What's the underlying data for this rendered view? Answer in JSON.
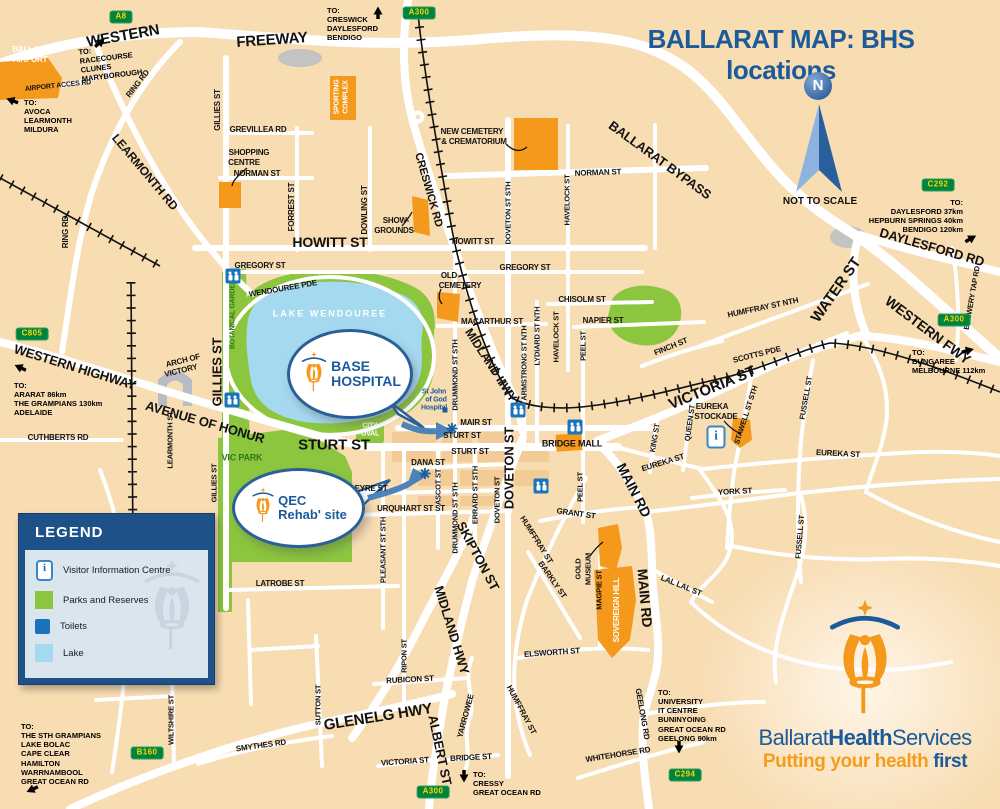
{
  "title": "BALLARAT MAP: BHS locations",
  "compass": {
    "letter": "N",
    "note": "NOT TO SCALE"
  },
  "legend": {
    "header": "LEGEND",
    "info_glyph": "i",
    "items": [
      {
        "icon": "visitor-info-icon",
        "label": "Visitor Information Centre"
      },
      {
        "icon": "parks-swatch",
        "label": "Parks and Reserves"
      },
      {
        "icon": "toilets-icon",
        "label": "Toilets"
      },
      {
        "icon": "lake-swatch",
        "label": "Lake"
      }
    ]
  },
  "callouts": {
    "base": {
      "line1": "BASE",
      "line2": "HOSPITAL"
    },
    "qec": {
      "line1": "QEC",
      "line2": "Rehab' site"
    }
  },
  "logo": {
    "word1": "Ballarat",
    "word2": "Health",
    "word3": "Services",
    "tag1": "Putting your health ",
    "tag2": "first"
  },
  "colors": {
    "accent_blue": "#1b5a9b",
    "orange": "#f5991c",
    "park_green": "#8cc63f",
    "lake_blue": "#a5d9ef",
    "sign_green": "#00833e",
    "sign_text": "#ffd400",
    "bg_tan": "#f8dcb2"
  },
  "signs": [
    {
      "label": "A8",
      "x": 121,
      "y": 17
    },
    {
      "label": "A300",
      "x": 419,
      "y": 13
    },
    {
      "label": "C292",
      "x": 938,
      "y": 185
    },
    {
      "label": "A300",
      "x": 954,
      "y": 320
    },
    {
      "label": "C805",
      "x": 32,
      "y": 334
    },
    {
      "label": "B160",
      "x": 147,
      "y": 753
    },
    {
      "label": "A300",
      "x": 433,
      "y": 792
    },
    {
      "label": "C294",
      "x": 685,
      "y": 775
    }
  ],
  "street_labels": [
    {
      "t": "WESTERN",
      "x": 123,
      "y": 36,
      "r": -10,
      "s": 15
    },
    {
      "t": "FREEWAY",
      "x": 272,
      "y": 40,
      "r": -4,
      "s": 15
    },
    {
      "t": "BALLARAT",
      "x": 33,
      "y": 50,
      "s": 8,
      "c": "#ffffff"
    },
    {
      "t": "AIRPORT",
      "x": 30,
      "y": 60,
      "s": 8,
      "c": "#ffffff"
    },
    {
      "t": "AIRPORT ACCES RD",
      "x": 58,
      "y": 86,
      "r": -6,
      "s": 7
    },
    {
      "t": "RING RD",
      "x": 138,
      "y": 84,
      "r": -52,
      "s": 8
    },
    {
      "t": "RING RD",
      "x": 66,
      "y": 232,
      "r": -90,
      "s": 8
    },
    {
      "t": "LEARMONTH RD",
      "x": 145,
      "y": 172,
      "r": 50,
      "s": 12
    },
    {
      "t": "GILLIES ST",
      "x": 218,
      "y": 110,
      "r": -90,
      "s": 8
    },
    {
      "t": "GREVILLEA RD",
      "x": 258,
      "y": 130,
      "s": 8
    },
    {
      "t": "SHOPPING",
      "x": 249,
      "y": 153,
      "s": 8
    },
    {
      "t": "CENTRE",
      "x": 244,
      "y": 163,
      "s": 8
    },
    {
      "t": "NORMAN ST",
      "x": 257,
      "y": 174,
      "s": 8
    },
    {
      "t": "FORREST ST",
      "x": 292,
      "y": 207,
      "r": -90,
      "s": 8
    },
    {
      "t": "DOWLING ST",
      "x": 365,
      "y": 210,
      "r": -90,
      "s": 8
    },
    {
      "t": "SPORTING",
      "x": 337,
      "y": 97,
      "r": -90,
      "s": 7,
      "c": "#ffffff"
    },
    {
      "t": "COMPLEX",
      "x": 346,
      "y": 97,
      "r": -90,
      "s": 7,
      "c": "#ffffff"
    },
    {
      "t": "CRESWICK RD",
      "x": 428,
      "y": 190,
      "r": 74,
      "s": 11
    },
    {
      "t": "NEW CEMETERY",
      "x": 472,
      "y": 132,
      "s": 8
    },
    {
      "t": "& CREMATORIUM",
      "x": 474,
      "y": 142,
      "s": 8
    },
    {
      "t": "NORMAN ST",
      "x": 598,
      "y": 173,
      "r": -2,
      "s": 8
    },
    {
      "t": "BALLARAT BYPASS",
      "x": 660,
      "y": 160,
      "r": 36,
      "s": 13
    },
    {
      "t": "DOVETON ST STH",
      "x": 508,
      "y": 213,
      "r": -90,
      "s": 7.5
    },
    {
      "t": "HAVELOCK ST",
      "x": 567,
      "y": 200,
      "r": -90,
      "s": 7.5
    },
    {
      "t": "SHOW-",
      "x": 396,
      "y": 221,
      "s": 8
    },
    {
      "t": "GROUNDS",
      "x": 394,
      "y": 231,
      "s": 8
    },
    {
      "t": "HOWITT ST",
      "x": 330,
      "y": 242,
      "s": 14
    },
    {
      "t": "HOWITT ST",
      "x": 473,
      "y": 242,
      "s": 8
    },
    {
      "t": "GREGORY ST",
      "x": 260,
      "y": 266,
      "s": 8
    },
    {
      "t": "GREGORY ST",
      "x": 525,
      "y": 268,
      "s": 8
    },
    {
      "t": "WENDOUREE PDE",
      "x": 283,
      "y": 289,
      "r": -10,
      "s": 8
    },
    {
      "t": "LAKE WENDOUREE",
      "x": 330,
      "y": 314,
      "s": 9,
      "c": "#ffffff",
      "ls": 2
    },
    {
      "t": "BOTANICAL GARDENS",
      "x": 233,
      "y": 312,
      "r": -90,
      "s": 7,
      "c": "#2f7a14"
    },
    {
      "t": "GILLIES ST",
      "x": 217,
      "y": 372,
      "r": -90,
      "s": 13
    },
    {
      "t": "OLD",
      "x": 449,
      "y": 276,
      "s": 8
    },
    {
      "t": "CEMETERY",
      "x": 460,
      "y": 286,
      "s": 8
    },
    {
      "t": "CHISOLM ST",
      "x": 582,
      "y": 300,
      "s": 8
    },
    {
      "t": "MACARTHUR ST",
      "x": 492,
      "y": 322,
      "s": 8
    },
    {
      "t": "NAPIER ST",
      "x": 603,
      "y": 321,
      "s": 8
    },
    {
      "t": "MIDLAND HWY",
      "x": 491,
      "y": 365,
      "r": 57,
      "s": 12
    },
    {
      "t": "DRUMMOND ST STH",
      "x": 455,
      "y": 375,
      "r": -90,
      "s": 7.5
    },
    {
      "t": "ARMSTRONG ST NTH",
      "x": 524,
      "y": 363,
      "r": -90,
      "s": 7.5
    },
    {
      "t": "LYDIARD ST NTH",
      "x": 537,
      "y": 336,
      "r": -90,
      "s": 7.5
    },
    {
      "t": "HAVELOCK ST",
      "x": 556,
      "y": 337,
      "r": -90,
      "s": 7.5
    },
    {
      "t": "PEEL ST",
      "x": 583,
      "y": 346,
      "r": -90,
      "s": 7.5
    },
    {
      "t": "FINCH ST",
      "x": 671,
      "y": 347,
      "r": -22,
      "s": 8
    },
    {
      "t": "SCOTTS PDE",
      "x": 757,
      "y": 355,
      "r": -14,
      "s": 8
    },
    {
      "t": "VICTORIA ST",
      "x": 712,
      "y": 388,
      "r": -22,
      "s": 15
    },
    {
      "t": "HUMFFRAY ST NTH",
      "x": 763,
      "y": 308,
      "r": -12,
      "s": 8
    },
    {
      "t": "WATER ST",
      "x": 836,
      "y": 290,
      "r": -55,
      "s": 15
    },
    {
      "t": "DAYLESFORD RD",
      "x": 932,
      "y": 247,
      "r": 16,
      "s": 13
    },
    {
      "t": "BREWERY TAP RD",
      "x": 972,
      "y": 298,
      "r": -80,
      "s": 7.5
    },
    {
      "t": "WESTERN FWY",
      "x": 928,
      "y": 330,
      "r": 37,
      "s": 14
    },
    {
      "t": "WESTERN HIGHWAY",
      "x": 75,
      "y": 367,
      "r": 17,
      "s": 13
    },
    {
      "t": "AVENUE OF HONUR",
      "x": 205,
      "y": 422,
      "r": 16,
      "s": 13
    },
    {
      "t": "ARCH OF",
      "x": 183,
      "y": 361,
      "r": -14,
      "s": 8
    },
    {
      "t": "VICTORY",
      "x": 181,
      "y": 371,
      "r": -14,
      "s": 8
    },
    {
      "t": "CUTHBERTS RD",
      "x": 58,
      "y": 438,
      "s": 8
    },
    {
      "t": "LEARMONTH ST",
      "x": 170,
      "y": 440,
      "r": -90,
      "s": 7.5
    },
    {
      "t": "GILLIES ST",
      "x": 214,
      "y": 483,
      "r": -90,
      "s": 7.5
    },
    {
      "t": "VIC PARK",
      "x": 242,
      "y": 458,
      "s": 9,
      "c": "#2f7a14"
    },
    {
      "t": "STURT ST",
      "x": 334,
      "y": 445,
      "s": 15
    },
    {
      "t": "STURT ST",
      "x": 462,
      "y": 436,
      "s": 8
    },
    {
      "t": "STURT ST",
      "x": 470,
      "y": 452,
      "s": 8
    },
    {
      "t": "MAIR ST",
      "x": 476,
      "y": 423,
      "s": 8
    },
    {
      "t": "CITY",
      "x": 370,
      "y": 426,
      "s": 7,
      "c": "#ffffff"
    },
    {
      "t": "OVAL",
      "x": 370,
      "y": 434,
      "s": 7,
      "c": "#ffffff"
    },
    {
      "t": "BRIDGE MALL",
      "x": 572,
      "y": 444,
      "s": 9
    },
    {
      "t": "DANA ST",
      "x": 428,
      "y": 463,
      "s": 8
    },
    {
      "t": "EYRE ST",
      "x": 371,
      "y": 489,
      "s": 8
    },
    {
      "t": "URQUHART ST ST",
      "x": 411,
      "y": 509,
      "s": 8
    },
    {
      "t": "PLEASANT ST STH",
      "x": 383,
      "y": 550,
      "r": -90,
      "s": 7.5
    },
    {
      "t": "DRUMMOND ST STH",
      "x": 455,
      "y": 518,
      "r": -90,
      "s": 7.5
    },
    {
      "t": "ERRARD ST STH",
      "x": 475,
      "y": 495,
      "r": -90,
      "s": 7.5
    },
    {
      "t": "ASCOT ST",
      "x": 438,
      "y": 487,
      "r": -90,
      "s": 7.5
    },
    {
      "t": "DOVETON ST",
      "x": 497,
      "y": 500,
      "r": -90,
      "s": 7.5
    },
    {
      "t": "DOVETON ST",
      "x": 509,
      "y": 468,
      "r": -90,
      "s": 13
    },
    {
      "t": "SKIPTON ST",
      "x": 478,
      "y": 556,
      "r": 62,
      "s": 13
    },
    {
      "t": "MIDLAND HWY",
      "x": 452,
      "y": 630,
      "r": 73,
      "s": 13
    },
    {
      "t": "ALBERT ST",
      "x": 440,
      "y": 750,
      "r": 78,
      "s": 13
    },
    {
      "t": "HUMFFRAY ST",
      "x": 536,
      "y": 540,
      "r": 58,
      "s": 8
    },
    {
      "t": "BARKLY ST",
      "x": 552,
      "y": 580,
      "r": 55,
      "s": 8
    },
    {
      "t": "GRANT ST",
      "x": 576,
      "y": 514,
      "r": 8,
      "s": 8
    },
    {
      "t": "PEEL ST",
      "x": 580,
      "y": 487,
      "r": -90,
      "s": 7.5
    },
    {
      "t": "GOLD",
      "x": 578,
      "y": 569,
      "r": -90,
      "s": 7.5
    },
    {
      "t": "MUSEUM",
      "x": 588,
      "y": 569,
      "r": -90,
      "s": 7.5
    },
    {
      "t": "MAGPIE ST",
      "x": 599,
      "y": 590,
      "r": -90,
      "s": 7.5
    },
    {
      "t": "SOVEREIGN HILL",
      "x": 617,
      "y": 610,
      "r": -90,
      "s": 8,
      "c": "#ffffff"
    },
    {
      "t": "MAIN RD",
      "x": 634,
      "y": 490,
      "r": 63,
      "s": 14
    },
    {
      "t": "MAIN RD",
      "x": 645,
      "y": 598,
      "r": 85,
      "s": 14
    },
    {
      "t": "EUREKA ST",
      "x": 663,
      "y": 463,
      "r": -17,
      "s": 8
    },
    {
      "t": "EUREKA ST",
      "x": 838,
      "y": 454,
      "r": 3,
      "s": 8
    },
    {
      "t": "YORK ST",
      "x": 735,
      "y": 492,
      "r": -3,
      "s": 8
    },
    {
      "t": "KING ST",
      "x": 655,
      "y": 438,
      "r": -80,
      "s": 7.5
    },
    {
      "t": "QUEEN ST",
      "x": 690,
      "y": 423,
      "r": -82,
      "s": 7.5
    },
    {
      "t": "EUREKA",
      "x": 712,
      "y": 407,
      "s": 8
    },
    {
      "t": "STOCKADE",
      "x": 716,
      "y": 417,
      "s": 8
    },
    {
      "t": "STAWELL ST STH",
      "x": 746,
      "y": 415,
      "r": -72,
      "s": 7.5
    },
    {
      "t": "FUSSELL ST",
      "x": 806,
      "y": 398,
      "r": -80,
      "s": 7.5
    },
    {
      "t": "FUSSELL ST",
      "x": 800,
      "y": 537,
      "r": -85,
      "s": 7.5
    },
    {
      "t": "LAL LAL ST",
      "x": 681,
      "y": 586,
      "r": 22,
      "s": 8
    },
    {
      "t": "ELSWORTH ST",
      "x": 552,
      "y": 653,
      "r": -4,
      "s": 8
    },
    {
      "t": "RUBICON ST",
      "x": 410,
      "y": 680,
      "r": -3,
      "s": 8
    },
    {
      "t": "RIPON ST",
      "x": 404,
      "y": 656,
      "r": -90,
      "s": 7.5
    },
    {
      "t": "SUTTON ST",
      "x": 318,
      "y": 705,
      "r": -90,
      "s": 7.5
    },
    {
      "t": "GLENELG HWY",
      "x": 378,
      "y": 717,
      "r": -9,
      "s": 15
    },
    {
      "t": "YARROWEE",
      "x": 466,
      "y": 716,
      "r": -75,
      "s": 8
    },
    {
      "t": "HUMFFRAY ST",
      "x": 521,
      "y": 710,
      "r": 62,
      "s": 8
    },
    {
      "t": "VICTORIA ST",
      "x": 405,
      "y": 762,
      "r": -4,
      "s": 8
    },
    {
      "t": "BRIDGE ST",
      "x": 471,
      "y": 758,
      "r": -3,
      "s": 8
    },
    {
      "t": "WHITEHORSE RD",
      "x": 618,
      "y": 755,
      "r": -9,
      "s": 8
    },
    {
      "t": "GEELONG RD",
      "x": 642,
      "y": 714,
      "r": 80,
      "s": 8
    },
    {
      "t": "LATROBE ST",
      "x": 280,
      "y": 584,
      "s": 8
    },
    {
      "t": "WILTSHIRE ST",
      "x": 171,
      "y": 720,
      "r": -90,
      "s": 7.5
    },
    {
      "t": "SMYTHES RD",
      "x": 261,
      "y": 746,
      "r": -8,
      "s": 8
    },
    {
      "t": "St John",
      "x": 434,
      "y": 392,
      "s": 7,
      "c": "#1b5a9b"
    },
    {
      "t": "of God",
      "x": 436,
      "y": 400,
      "s": 7,
      "c": "#1b5a9b"
    },
    {
      "t": "Hospital",
      "x": 434,
      "y": 408,
      "s": 7,
      "c": "#1b5a9b"
    }
  ],
  "destinations": [
    {
      "x": 80,
      "y": 44,
      "rot": -7,
      "lines": [
        "TO:",
        "RACECOURSE",
        "CLUNES",
        "MARYBOROUGH"
      ],
      "arrow": {
        "x": 100,
        "y": 45,
        "r": -40
      }
    },
    {
      "x": 24,
      "y": 98,
      "lines": [
        "TO:",
        "AVOCA",
        "LEARMONTH",
        "MILDURA"
      ],
      "arrow": {
        "x": 12,
        "y": 103,
        "r": 200
      }
    },
    {
      "x": 327,
      "y": 6,
      "lines": [
        "TO:",
        "CRESWICK",
        "DAYLESFORD",
        "BENDIGO"
      ],
      "arrow": {
        "x": 378,
        "y": 15,
        "r": -90
      }
    },
    {
      "x": 843,
      "y": 198,
      "w": 120,
      "align": "right",
      "lines": [
        "TO:",
        "DAYLESFORD 37km",
        "HEPBURN SPRINGS 40km",
        "BENDIGO 120km"
      ],
      "arrow": {
        "x": 971,
        "y": 241,
        "r": -30
      }
    },
    {
      "x": 912,
      "y": 348,
      "lines": [
        "TO:",
        "BUNGAREE",
        "MELBOURNE 112km"
      ],
      "arrow": {
        "x": 968,
        "y": 353,
        "r": -15
      }
    },
    {
      "x": 14,
      "y": 381,
      "lines": [
        "TO:",
        "ARARAT 86km",
        "THE GRAMPIANS 130km",
        "ADELAIDE"
      ],
      "arrow": {
        "x": 20,
        "y": 370,
        "r": 205
      }
    },
    {
      "x": 21,
      "y": 722,
      "lines": [
        "TO:",
        "THE STH GRAMPIANS",
        "LAKE BOLAC",
        "CAPE CLEAR",
        "HAMILTON",
        "WARRNAMBOOL",
        "GREAT OCEAN RD"
      ],
      "arrow": {
        "x": 32,
        "y": 792,
        "r": 155
      }
    },
    {
      "x": 473,
      "y": 770,
      "lines": [
        "TO:",
        "CRESSY",
        "GREAT OCEAN RD"
      ],
      "arrow": {
        "x": 464,
        "y": 779,
        "r": 90
      }
    },
    {
      "x": 658,
      "y": 688,
      "lines": [
        "TO:",
        "UNIVERSITY",
        "IT CENTRE",
        "BUNINYOING",
        "GREAT OCEAN RD",
        "GEELONG 90km"
      ],
      "arrow": {
        "x": 679,
        "y": 750,
        "r": 90
      }
    }
  ],
  "markers": {
    "toilets": [
      [
        233,
        276
      ],
      [
        232,
        400
      ],
      [
        518,
        410
      ],
      [
        575,
        427
      ],
      [
        541,
        486
      ]
    ],
    "info": [
      [
        716,
        437
      ]
    ],
    "stars": [
      [
        452,
        431
      ],
      [
        425,
        476
      ]
    ],
    "dots": [
      [
        445,
        410
      ]
    ]
  }
}
